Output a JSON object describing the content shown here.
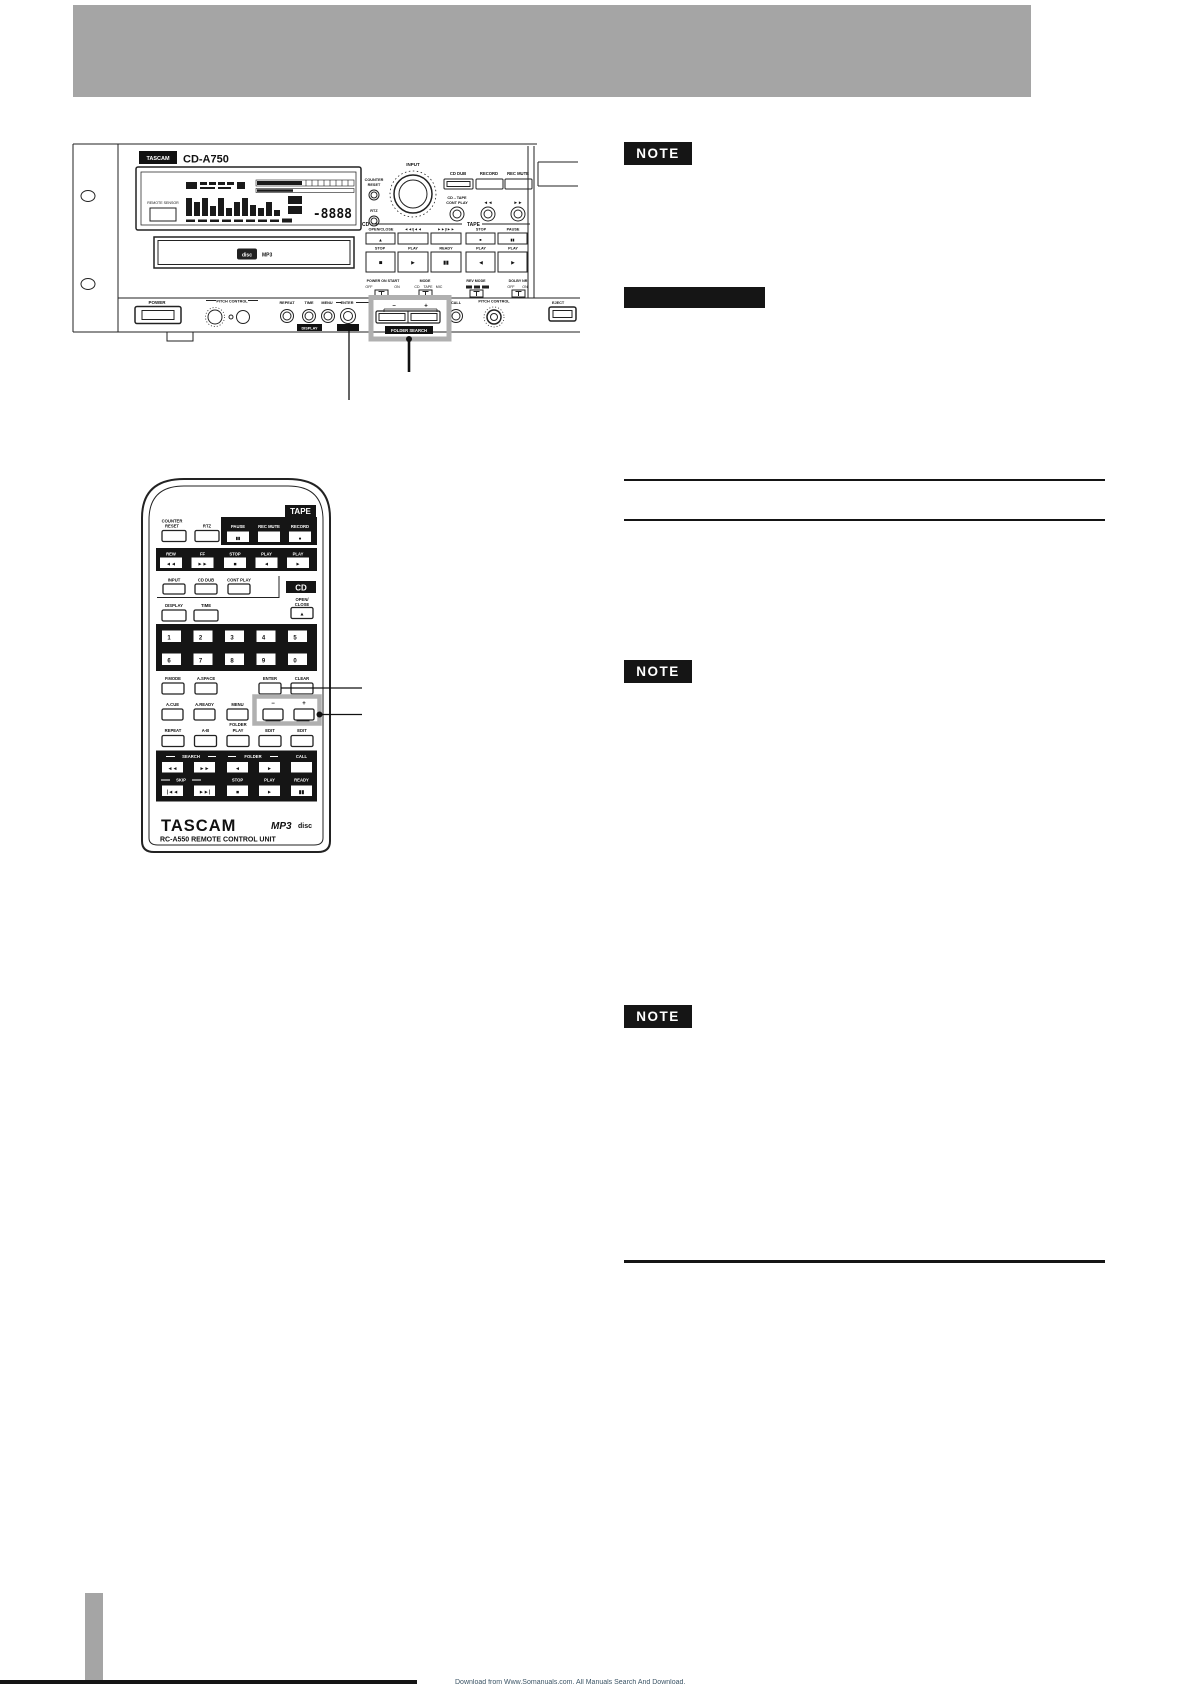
{
  "page": {
    "header_color": "#a5a5a5",
    "tab_color": "#a5a5a5",
    "footer_watermark": "Download from Www.Somanuals.com. All Manuals Search And Download."
  },
  "notes": {
    "n1": "NOTE",
    "n2": "NOTE",
    "n3": "NOTE"
  },
  "panel": {
    "brand": "TASCAM",
    "model": "CD-A750",
    "remote_sensor": "REMOTE SENSOR",
    "counter": "COUNTER",
    "reset": "RESET",
    "rtz": "RTZ",
    "input": "INPUT",
    "cd_dub": "CD DUB",
    "record": "RECORD",
    "rec_mute": "REC MUTE",
    "cd_tape": "CD→TAPE",
    "cont_play": "CONT PLAY",
    "rew_sym": "◄◄",
    "ff_sym": "►►",
    "cd": "CD",
    "open_close": "OPEN/CLOSE",
    "skip_back": "◄◄/|◄◄",
    "skip_fwd": "►►|/►►",
    "tape": "TAPE",
    "stop": "STOP",
    "pause": "PAUSE",
    "play": "PLAY",
    "ready": "READY",
    "eject_sym": "▲",
    "stop_sym": "■",
    "play_sym": "►",
    "pause_sym": "▮▮",
    "rev_sym": "◄",
    "power_on_start": "POWER ON START",
    "off": "OFF",
    "on": "ON",
    "mode": "MODE",
    "mode_cd": "CD",
    "mode_tape": "TAPE",
    "mode_mic": "MIC",
    "rev_mode": "REV MODE",
    "dolby_nr": "DOLBY NR",
    "power": "POWER",
    "pitch_control": "PITCH CONTROL",
    "repeat": "REPEAT",
    "time": "TIME",
    "display_badge": "DISPLAY",
    "menu": "MENU",
    "enter": "ENTER",
    "minus": "−",
    "plus": "+",
    "folder_search": "FOLDER SEARCH",
    "call": "CALL",
    "eject": "EJECT",
    "lcd_digits": "-8888",
    "disc_logo": "disc",
    "mp3_logo": "MP3"
  },
  "remote": {
    "tape_badge": "TAPE",
    "counter": "COUNTER",
    "reset": "RESET",
    "rtz": "RTZ",
    "pause": "PAUSE",
    "rec_mute": "REC MUTE",
    "record": "RECORD",
    "rew": "REW",
    "ff": "FF",
    "stop": "STOP",
    "play": "PLAY",
    "rew_sym": "◄◄",
    "ff_sym": "►►",
    "stop_sym": "■",
    "rev_sym": "◄",
    "play_sym": "►",
    "pause_sym": "▮▮",
    "record_sym": "●",
    "eject_sym": "▲",
    "skip_back_sym": "|◄◄",
    "skip_fwd_sym": "►►|",
    "input": "INPUT",
    "cd_dub": "CD DUB",
    "cont_play": "CONT PLAY",
    "cd_badge": "CD",
    "open": "OPEN/",
    "close": "CLOSE",
    "display": "DISPLAY",
    "time": "TIME",
    "digits": [
      "1",
      "2",
      "3",
      "4",
      "5",
      "6",
      "7",
      "8",
      "9",
      "0"
    ],
    "p_mode": "P.MODE",
    "a_space": "A.SPACE",
    "enter": "ENTER",
    "clear": "CLEAR",
    "a_cue": "A.CUE",
    "a_ready": "A.READY",
    "menu": "MENU",
    "minus": "−",
    "plus": "+",
    "folder": "FOLDER",
    "play_small": "PLAY",
    "repeat": "REPEAT",
    "a_b": "A-B",
    "edit": "EDIT",
    "search": "SEARCH",
    "folder_grp": "FOLDER",
    "call": "CALL",
    "skip": "SKIP",
    "ready": "READY",
    "brand": "TASCAM",
    "mp3": "MP3",
    "disc": "disc",
    "unit": "RC-A550 REMOTE CONTROL UNIT"
  }
}
